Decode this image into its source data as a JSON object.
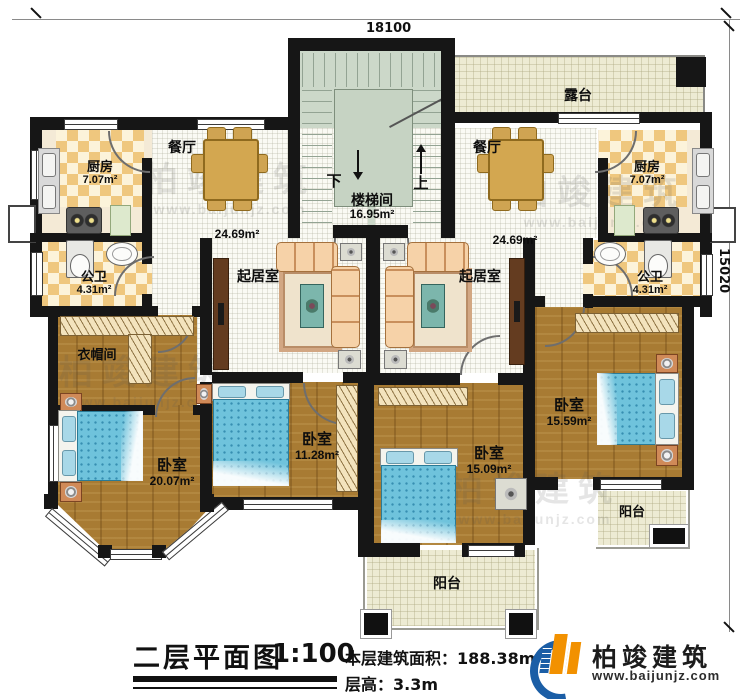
{
  "dimensions": {
    "width_mm": "18100",
    "height_mm": "15020"
  },
  "stairwell": {
    "name": "楼梯间",
    "area": "16.95m²",
    "down": "下",
    "up": "上"
  },
  "terrace": {
    "name": "露台"
  },
  "left_unit": {
    "kitchen": {
      "name": "厨房",
      "area": "7.07m²"
    },
    "dining": {
      "name": "餐厅"
    },
    "hall_area": "24.69m²",
    "bath": {
      "name": "公卫",
      "area": "4.31m²"
    },
    "living": {
      "name": "起居室"
    },
    "cloakroom": {
      "name": "衣帽间"
    },
    "bedroom_master": {
      "name": "卧室",
      "area": "20.07m²"
    },
    "bedroom_small": {
      "name": "卧室",
      "area": "11.28m²"
    }
  },
  "right_unit": {
    "kitchen": {
      "name": "厨房",
      "area": "7.07m²"
    },
    "dining": {
      "name": "餐厅"
    },
    "hall_area": "24.69m²",
    "bath": {
      "name": "公卫",
      "area": "4.31m²"
    },
    "living": {
      "name": "起居室"
    },
    "bedroom_center": {
      "name": "卧室",
      "area": "15.09m²"
    },
    "bedroom_right": {
      "name": "卧室",
      "area": "15.59m²"
    }
  },
  "balconies": {
    "bottom": "阳台",
    "right": "阳台"
  },
  "titleblock": {
    "title": "二层平面图",
    "scale": "1:100",
    "area_label": "本层建筑面积：",
    "area_value": "188.38m²",
    "height_label": "层高：",
    "height_value": "3.3m"
  },
  "logo": {
    "name": "柏竣建筑",
    "url": "www.baijunjz.com"
  },
  "watermark": {
    "name": "柏竣建筑",
    "url": "www.baijunjz.com"
  }
}
